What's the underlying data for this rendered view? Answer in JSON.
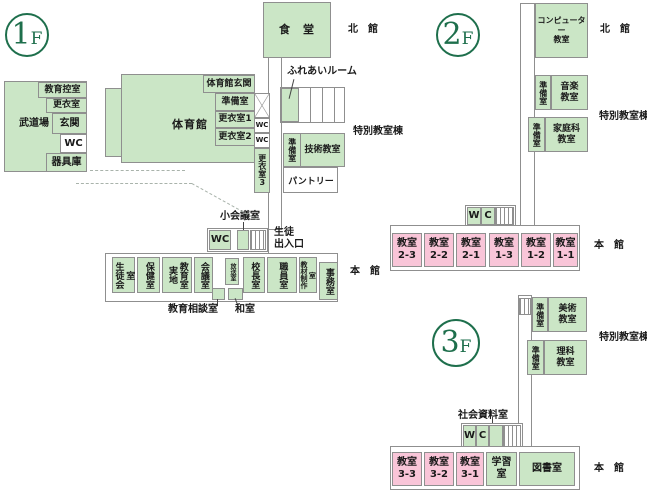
{
  "colors": {
    "room_green": "#cbe6c6",
    "room_pink": "#f9c5d8",
    "accent_green": "#1e6f4c",
    "border_gray": "#8f8f8f"
  },
  "f1": {
    "badge": "1F",
    "dining": "食　堂",
    "north_label": "北　館",
    "special_label": "特別教室棟",
    "budokan": {
      "budojo": "武道場",
      "kyoiku_hikae": "教育控室",
      "koishitsu": "更衣室",
      "genkan": "玄関",
      "wc": "WC",
      "kiguko": "器具庫"
    },
    "gym": {
      "name": "体育館",
      "entrance": "体育館玄関",
      "junbi": "準備室",
      "koi1": "更衣室1",
      "koi2": "更衣室2"
    },
    "east": {
      "wc_upper": "WC",
      "wc_lower": "WC",
      "koi3": "更衣室3"
    },
    "fureai": "ふれあいルーム",
    "tech": {
      "junbi": "準備室",
      "room": "技術教室"
    },
    "pantry": "パントリー",
    "small_meeting": "小会議室",
    "wc_main": "WC",
    "entrance_label": "生徒\n出入口",
    "honkan": {
      "label": "本　館",
      "seitokai": "生徒会室",
      "hoken": "保健室",
      "jicchi": "実地\n教育室",
      "kaigi": "会議室",
      "hoso": "放送室",
      "kocho": "校長室",
      "shokuin": "職員室",
      "kyozai": "教材制作室",
      "jimu": "事務室",
      "sodan": "教育相談室",
      "washitsu": "和室"
    }
  },
  "f2": {
    "badge": "2F",
    "computer": "コンピューター\n教室",
    "north_label": "北　館",
    "music_junbi": "準備室",
    "music": "音楽\n教室",
    "special_label": "特別教室棟",
    "home_junbi": "準備室",
    "home_ec": "家庭科\n教室",
    "w": "W",
    "c": "C",
    "classrooms": [
      "教室\n2-3",
      "教室\n2-2",
      "教室\n2-1",
      "教室\n1-3",
      "教室\n1-2",
      "教室\n1-1"
    ],
    "main_label": "本　館"
  },
  "f3": {
    "badge": "3F",
    "art_junbi": "準備室",
    "art": "美術\n教室",
    "special_label": "特別教室棟",
    "sci_junbi": "準備室",
    "science": "理科\n教室",
    "shakai": "社会資料室",
    "w": "W",
    "c": "C",
    "classrooms": [
      "教室\n3-3",
      "教室\n3-2",
      "教室\n3-1"
    ],
    "gakushu": "学習室",
    "tosho": "図書室",
    "main_label": "本　館"
  }
}
